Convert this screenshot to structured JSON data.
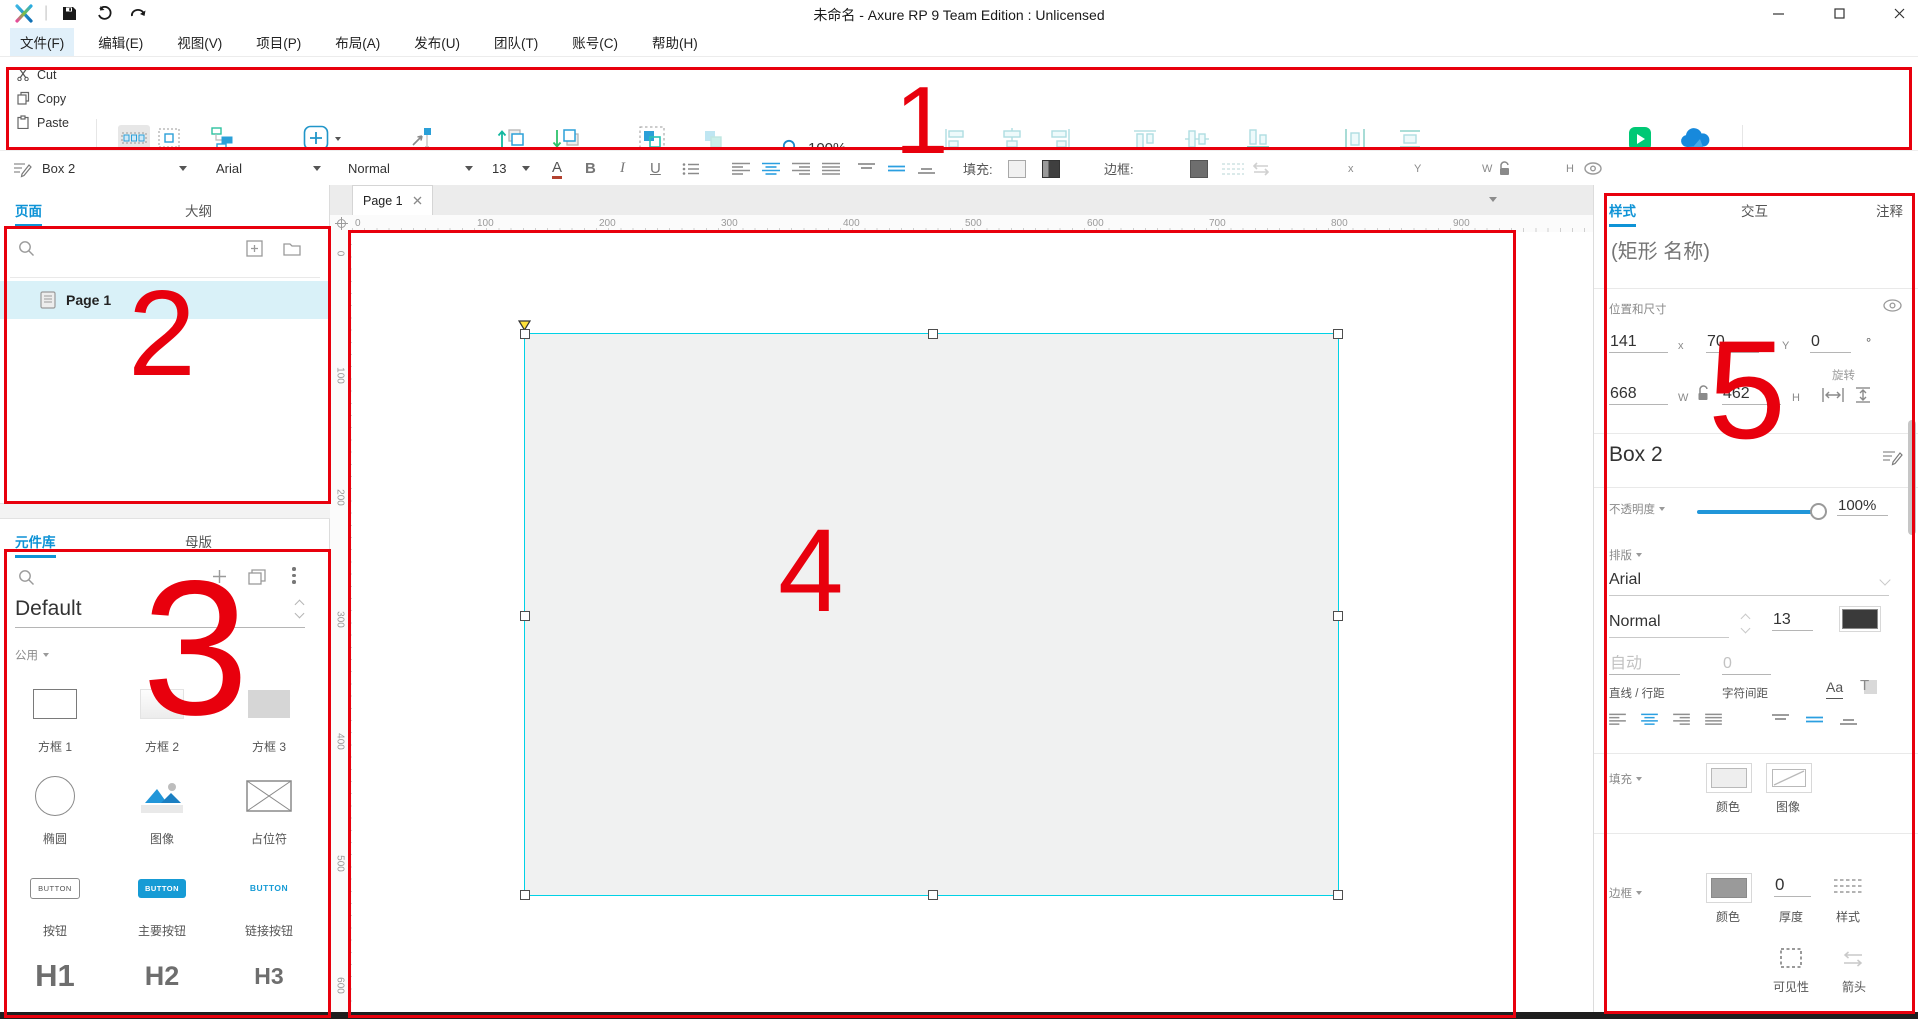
{
  "window": {
    "title": "未命名 - Axure RP 9 Team Edition : Unlicensed"
  },
  "menu": {
    "items": [
      "文件(F)",
      "编辑(E)",
      "视图(V)",
      "项目(P)",
      "布局(A)",
      "发布(U)",
      "团队(T)",
      "账号(C)",
      "帮助(H)"
    ]
  },
  "toolbar": {
    "cut": "Cut",
    "copy": "Copy",
    "paste": "Paste",
    "select_mode": "选择模式",
    "connect": "连接",
    "insert": "插入",
    "anchors": "控点",
    "bring_to_front": "顶层",
    "send_to_back": "底层",
    "group": "组合",
    "ungroup": "取消组合",
    "zoom_value": "100%",
    "align_left": "左",
    "align_center": "居中",
    "align_right": "右",
    "align_top": "顶部",
    "align_middle": "居中",
    "align_bottom": "底部矩形",
    "distribute_horizontal": "横向",
    "distribute_vertical": "垂直",
    "preview": "预览",
    "share": "共享",
    "account": "Mxiang_yu"
  },
  "format_bar": {
    "widget_style": "Box 2",
    "font_family": "Arial",
    "font_weight": "Normal",
    "font_size": "13",
    "fill_label": "填充:",
    "border_label": "边框:",
    "border_width": "0",
    "x": "141",
    "x_label": "x",
    "y": "70",
    "y_label": "Y",
    "w": "668",
    "w_label": "W",
    "h": "462",
    "h_label": "H"
  },
  "pages_panel": {
    "tab_pages": "页面",
    "tab_outline": "大纲",
    "page_name": "Page 1"
  },
  "widgets_panel": {
    "tab_widgets": "元件库",
    "tab_masters": "母版",
    "library_name": "Default",
    "category": "公用",
    "items": [
      {
        "label": "方框 1",
        "preview": ""
      },
      {
        "label": "方框 2",
        "preview": ""
      },
      {
        "label": "方框 3",
        "preview": ""
      },
      {
        "label": "椭圆",
        "preview": ""
      },
      {
        "label": "图像",
        "preview": ""
      },
      {
        "label": "占位符",
        "preview": ""
      },
      {
        "label": "按钮",
        "preview": "BUTTON"
      },
      {
        "label": "主要按钮",
        "preview": "BUTTON"
      },
      {
        "label": "链接按钮",
        "preview": "BUTTON"
      },
      {
        "label": "标题 1",
        "preview": "H1"
      },
      {
        "label": "标题 2",
        "preview": "H2"
      },
      {
        "label": "标题 3",
        "preview": "H3"
      }
    ]
  },
  "canvas": {
    "tab_label": "Page 1",
    "h_ruler": [
      "0",
      "100",
      "200",
      "300",
      "400",
      "500",
      "600",
      "700",
      "800",
      "900"
    ],
    "v_ruler": [
      "0",
      "100",
      "200",
      "300",
      "400",
      "500",
      "600"
    ]
  },
  "style_panel": {
    "tab_style": "样式",
    "tab_interactions": "交互",
    "tab_notes": "注释",
    "name_placeholder": "(矩形 名称)",
    "position_section": "位置和尺寸",
    "x": "141",
    "x_label": "x",
    "y": "70",
    "y_label": "Y",
    "rotation": "0",
    "degree_label": "°",
    "rotation_label": "旋转",
    "w": "668",
    "w_label": "W",
    "h": "462",
    "h_label": "H",
    "widget_style": "Box 2",
    "opacity_label": "不透明度",
    "opacity_value": "100%",
    "typography_label": "排版",
    "font_family": "Arial",
    "font_weight": "Normal",
    "font_size": "13",
    "line_height_placeholder": "自动",
    "line_height_label": "直线 / 行距",
    "char_spacing_value": "0",
    "char_spacing_label": "字符间距",
    "fill_section": "填充",
    "fill_color_label": "颜色",
    "fill_image_label": "图像",
    "border_section": "边框",
    "border_color_label": "颜色",
    "border_width": "0",
    "border_width_label": "厚度",
    "border_style_label": "样式",
    "visibility_label": "可见性",
    "arrow_label": "箭头"
  },
  "selection": {
    "x": 141,
    "y": 70,
    "w": 668,
    "h": 462
  },
  "annotations": {
    "n1": "1",
    "n2": "2",
    "n3": "3",
    "n4": "4",
    "n5": "5"
  },
  "colors": {
    "annotation_red": "#e8000d",
    "accent_blue": "#169bd5",
    "selection_cyan": "#00d2e6",
    "preview_green": "#00c875",
    "share_blue": "#1789dc",
    "selected_page_bg": "#d9f1f8",
    "shape_fill": "#f0f1f1"
  }
}
